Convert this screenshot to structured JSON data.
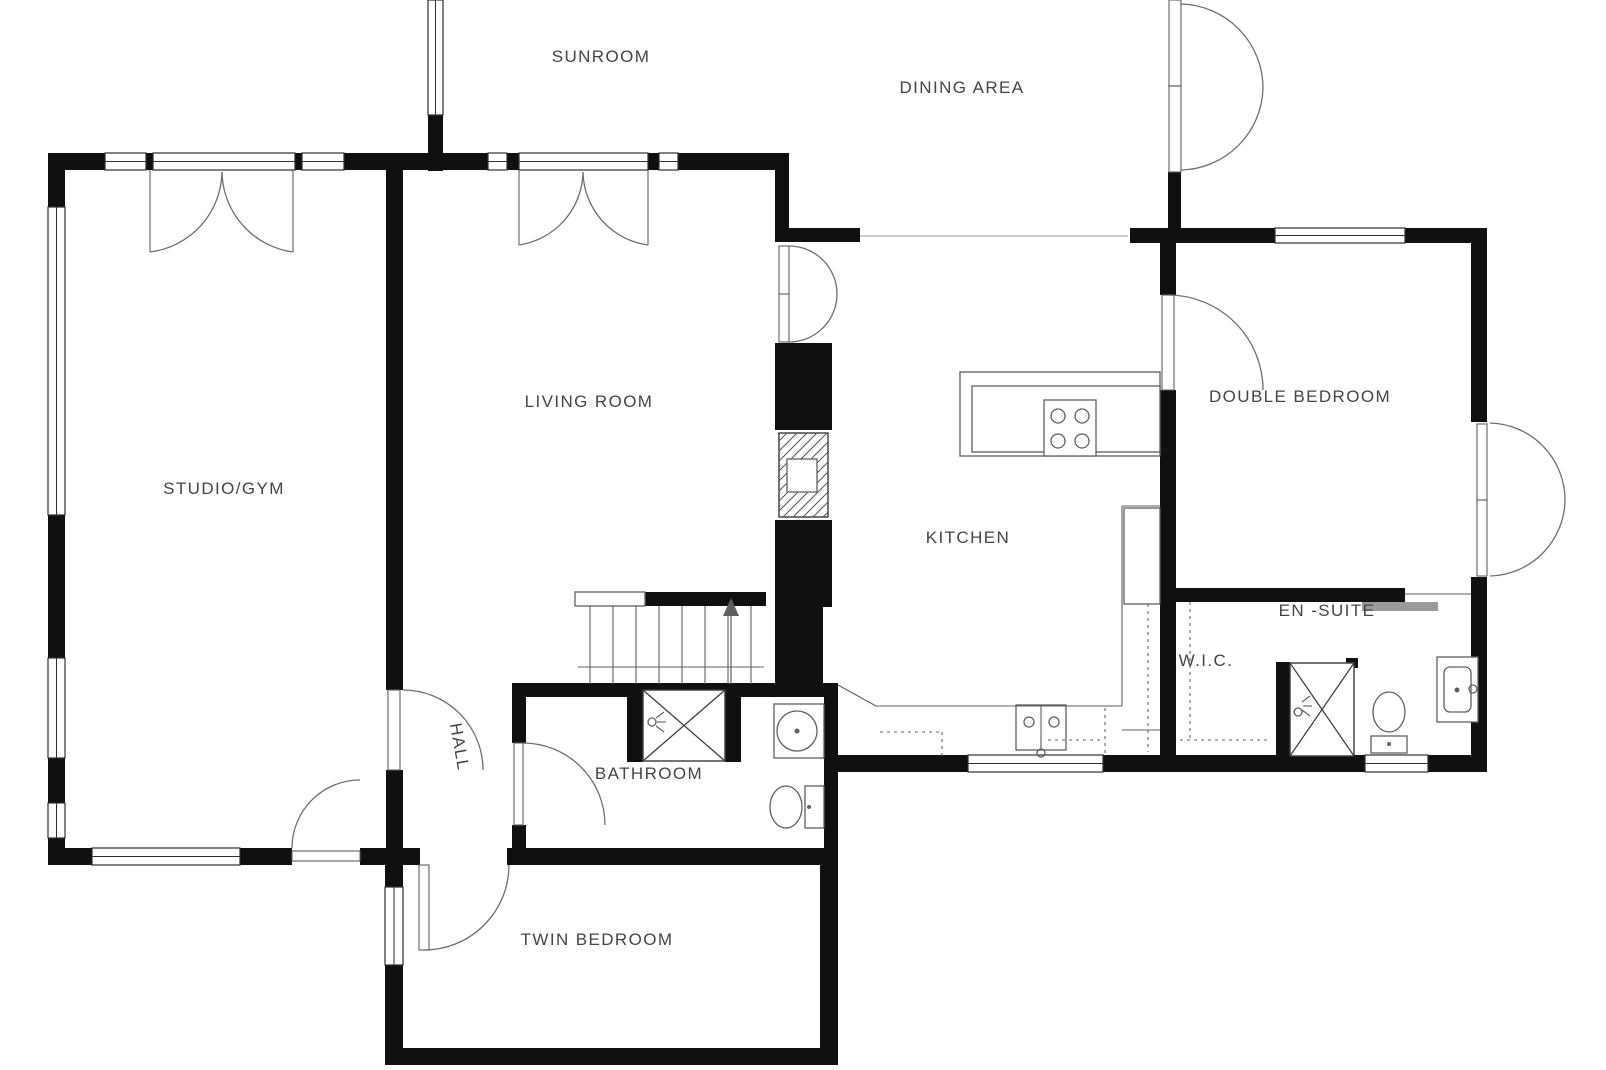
{
  "plan": {
    "title": "floor-plan",
    "width": 1606,
    "height": 1070,
    "colors": {
      "background": "#ffffff",
      "wall": "#101010",
      "window_stroke": "#2f2f2f",
      "line": "#5f5f5f",
      "arc": "#6e6e6e",
      "dash": "#666666",
      "text": "#444444",
      "radiator": "#9a9a9a"
    },
    "labels": [
      {
        "id": "sunroom",
        "text": "SUNROOM",
        "x": 601,
        "y": 57,
        "rotate": 0
      },
      {
        "id": "dining-area",
        "text": "DINING AREA",
        "x": 962,
        "y": 88,
        "rotate": 0
      },
      {
        "id": "studio-gym",
        "text": "STUDIO/GYM",
        "x": 224,
        "y": 489,
        "rotate": 0
      },
      {
        "id": "living-room",
        "text": "LIVING ROOM",
        "x": 589,
        "y": 402,
        "rotate": 0
      },
      {
        "id": "kitchen",
        "text": "KITCHEN",
        "x": 968,
        "y": 538,
        "rotate": 0
      },
      {
        "id": "double-bedroom",
        "text": "DOUBLE BEDROOM",
        "x": 1300,
        "y": 397,
        "rotate": 0
      },
      {
        "id": "en-suite",
        "text": "EN -SUITE",
        "x": 1327,
        "y": 611,
        "rotate": 0
      },
      {
        "id": "wic",
        "text": "W.I.C.",
        "x": 1206,
        "y": 661,
        "rotate": 0
      },
      {
        "id": "hall",
        "text": "HALL",
        "x": 459,
        "y": 747,
        "rotate": 80
      },
      {
        "id": "bathroom",
        "text": "BATHROOM",
        "x": 649,
        "y": 774,
        "rotate": 0
      },
      {
        "id": "twin-bedroom",
        "text": "TWIN BEDROOM",
        "x": 597,
        "y": 940,
        "rotate": 0
      }
    ],
    "geo": {
      "walls": [
        [
          48,
          153,
          57,
          17
        ],
        [
          146,
          153,
          7,
          17
        ],
        [
          295,
          153,
          7,
          17
        ],
        [
          344,
          153,
          144,
          17
        ],
        [
          507,
          153,
          12,
          17
        ],
        [
          648,
          153,
          11,
          17
        ],
        [
          678,
          153,
          111,
          17
        ],
        [
          48,
          153,
          17,
          54
        ],
        [
          48,
          264,
          17,
          5
        ],
        [
          48,
          331,
          17,
          5
        ],
        [
          48,
          515,
          17,
          143
        ],
        [
          48,
          758,
          17,
          45
        ],
        [
          48,
          838,
          17,
          27
        ],
        [
          48,
          848,
          44,
          17
        ],
        [
          163,
          848,
          6,
          17
        ],
        [
          240,
          848,
          52,
          17
        ],
        [
          360,
          848,
          43,
          17
        ],
        [
          386,
          153,
          17,
          537
        ],
        [
          386,
          770,
          17,
          95
        ],
        [
          403,
          848,
          17,
          17
        ],
        [
          507,
          848,
          5,
          17
        ],
        [
          775,
          153,
          14,
          89
        ],
        [
          775,
          343,
          57,
          87
        ],
        [
          775,
          520,
          57,
          87
        ],
        [
          775,
          607,
          48,
          78
        ],
        [
          775,
          228,
          85,
          14
        ],
        [
          512,
          683,
          326,
          14
        ],
        [
          512,
          683,
          14,
          60
        ],
        [
          512,
          825,
          14,
          40
        ],
        [
          824,
          683,
          14,
          182
        ],
        [
          627,
          683,
          16,
          79
        ],
        [
          725,
          683,
          16,
          79
        ],
        [
          512,
          848,
          326,
          17
        ],
        [
          385,
          865,
          18,
          22
        ],
        [
          385,
          965,
          18,
          83
        ],
        [
          385,
          1048,
          453,
          17
        ],
        [
          820,
          865,
          18,
          183
        ],
        [
          838,
          755,
          130,
          17
        ],
        [
          1035,
          755,
          6,
          17
        ],
        [
          1103,
          755,
          262,
          17
        ],
        [
          1428,
          755,
          59,
          17
        ],
        [
          428,
          115,
          15,
          56
        ],
        [
          428,
          50,
          15,
          5
        ],
        [
          1168,
          172,
          13,
          71
        ],
        [
          1130,
          228,
          145,
          15
        ],
        [
          1338,
          228,
          6,
          15
        ],
        [
          1405,
          228,
          82,
          15
        ],
        [
          1160,
          243,
          16,
          52
        ],
        [
          1160,
          390,
          16,
          382
        ],
        [
          1471,
          243,
          16,
          179
        ],
        [
          1471,
          577,
          16,
          178
        ],
        [
          1160,
          588,
          245,
          14
        ],
        [
          1276,
          662,
          14,
          95
        ],
        [
          1346,
          658,
          12,
          10
        ],
        [
          645,
          592,
          121,
          14
        ]
      ],
      "windows": [
        [
          105,
          153,
          41,
          17
        ],
        [
          153,
          153,
          142,
          17
        ],
        [
          302,
          153,
          42,
          17
        ],
        [
          488,
          153,
          19,
          17
        ],
        [
          519,
          153,
          129,
          17
        ],
        [
          659,
          153,
          19,
          17
        ],
        [
          48,
          207,
          17,
          308
        ],
        [
          48,
          658,
          17,
          100
        ],
        [
          48,
          803,
          17,
          35
        ],
        [
          92,
          848,
          148,
          17
        ],
        [
          428,
          0,
          15,
          115
        ],
        [
          385,
          887,
          18,
          78
        ],
        [
          968,
          755,
          135,
          17
        ],
        [
          1365,
          755,
          63,
          17
        ],
        [
          1275,
          228,
          130,
          15
        ]
      ],
      "leaves": [
        [
          292,
          851,
          68,
          10,
          "studio-exterior-door-leaf"
        ],
        [
          388,
          690,
          12,
          80,
          "hall-door-leaf"
        ],
        [
          514,
          743,
          9,
          82,
          "bathroom-door-leaf"
        ],
        [
          419,
          865,
          10,
          85,
          "twin-bedroom-door-leaf"
        ],
        [
          1162,
          295,
          12,
          95,
          "double-bedroom-door-leaf"
        ],
        [
          779,
          246,
          10,
          48,
          "living-room-door-leaf"
        ],
        [
          779,
          294,
          10,
          48,
          "living-room-door-leaf"
        ],
        [
          1169,
          0,
          12,
          86,
          "dining-french-door-leaf"
        ],
        [
          1169,
          86,
          12,
          86,
          "dining-french-door-leaf"
        ],
        [
          1477,
          424,
          10,
          76,
          "bedroom-french-door-leaf"
        ],
        [
          1477,
          500,
          10,
          76,
          "bedroom-french-door-leaf"
        ]
      ],
      "arcs": [
        "M150,252 A82 82 0 0 0 222,172",
        "M293,252 A82 82 0 0 1 222,172",
        "M519,245 A75 75 0 0 0 583,172",
        "M648,245 A75 75 0 0 1 583,172",
        "M789,246 A48 48 0 0 1 837,294",
        "M789,342 A48 48 0 0 0 837,294",
        "M1181,4 A84 84 0 0 1 1263,88",
        "M1181,170 A84 84 0 0 0 1263,88",
        "M1490,423 A77 77 0 0 1 1565,500",
        "M1490,576 A77 77 0 0 0 1565,500",
        "M292,848 A68 68 0 0 1 360,780",
        "M403,690 A80 80 0 0 1 483,770",
        "M523,743 A82 82 0 0 1 605,825",
        "M424,950 A85 85 0 0 0 509,865",
        "M1168,295 A95 95 0 0 1 1263,390"
      ],
      "boxes": [
        [
          960,
          372,
          200,
          84,
          0,
          "kitchen-island"
        ],
        [
          972,
          386,
          188,
          66,
          0,
          "kitchen-island-inner"
        ],
        [
          1044,
          400,
          52,
          56,
          0,
          "stove"
        ],
        [
          1016,
          705,
          50,
          45,
          0,
          "kitchen-sink"
        ],
        [
          1124,
          508,
          36,
          96,
          0,
          "kitchen-cabinet"
        ],
        [
          774,
          704,
          50,
          54,
          0,
          "bathroom-basin"
        ],
        [
          1437,
          657,
          41,
          65,
          0,
          "ensuite-basin"
        ],
        [
          1444,
          667,
          27,
          45,
          6,
          "ensuite-basin-inner"
        ],
        [
          575,
          592,
          70,
          14,
          0,
          "stair-rail"
        ],
        [
          1371,
          736,
          36,
          17,
          0,
          "ensuite-toilet-tank"
        ],
        [
          805,
          786,
          19,
          42,
          0,
          "bathroom-toilet-tank"
        ],
        [
          787,
          459,
          30,
          33,
          0,
          "chimney-flue"
        ]
      ],
      "xboxes": [
        [
          643,
          690,
          82,
          71,
          "bathroom-shower"
        ],
        [
          1290,
          663,
          64,
          93,
          "ensuite-shower"
        ]
      ],
      "hatch": [
        779,
        433,
        49,
        84
      ],
      "lines": [
        [
          150,
          170,
          150,
          252
        ],
        [
          293,
          170,
          293,
          252
        ],
        [
          519,
          170,
          519,
          245
        ],
        [
          648,
          170,
          648,
          245
        ],
        [
          590,
          606,
          590,
          684
        ],
        [
          613,
          606,
          613,
          684
        ],
        [
          636,
          606,
          636,
          684
        ],
        [
          659,
          606,
          659,
          684
        ],
        [
          682,
          606,
          682,
          684
        ],
        [
          705,
          606,
          705,
          684
        ],
        [
          728,
          606,
          728,
          684
        ],
        [
          751,
          606,
          751,
          684
        ],
        [
          578,
          667,
          764,
          667
        ],
        [
          838,
          685,
          876,
          706
        ],
        [
          876,
          706,
          1122,
          706
        ],
        [
          1122,
          706,
          1122,
          506
        ],
        [
          1122,
          506,
          1160,
          506
        ],
        [
          1122,
          730,
          1160,
          730
        ],
        [
          1041,
          705,
          1041,
          750
        ],
        [
          1041,
          742,
          1041,
          749
        ],
        [
          1168,
          86,
          1181,
          86
        ],
        [
          1405,
          594,
          1471,
          594
        ],
        [
          656,
          718,
          664,
          712
        ],
        [
          657,
          722,
          666,
          722
        ],
        [
          656,
          726,
          664,
          732
        ],
        [
          1302,
          702,
          1310,
          696
        ],
        [
          1303,
          706,
          1312,
          706
        ],
        [
          1302,
          710,
          1310,
          716
        ]
      ],
      "threshold": [
        [
          860,
          236,
          1128,
          236
        ]
      ],
      "dashed": [
        [
          880,
          732,
          942,
          732
        ],
        [
          942,
          732,
          942,
          757
        ],
        [
          1105,
          708,
          1105,
          757
        ],
        [
          1148,
          604,
          1148,
          752
        ],
        [
          1180,
          740,
          1268,
          740
        ],
        [
          1190,
          602,
          1190,
          740
        ],
        [
          1048,
          740,
          1102,
          740
        ]
      ],
      "circles": [
        [
          1058,
          416,
          7
        ],
        [
          1082,
          416,
          7
        ],
        [
          1058,
          441,
          7
        ],
        [
          1082,
          441,
          7
        ],
        [
          797,
          731,
          20
        ],
        [
          1029,
          722,
          5
        ],
        [
          1054,
          722,
          5
        ],
        [
          1041,
          753,
          4
        ],
        [
          652,
          722,
          4
        ],
        [
          1298,
          712,
          4
        ],
        [
          1473,
          689,
          4
        ]
      ],
      "dots": [
        [
          797,
          731,
          2.5
        ],
        [
          1457,
          690,
          2.5
        ],
        [
          809,
          807,
          2
        ],
        [
          1389,
          744,
          2
        ]
      ],
      "ellipses": [
        [
          786,
          807,
          16,
          21,
          "bathroom-toilet-bowl"
        ],
        [
          1389,
          712,
          16,
          20,
          "ensuite-toilet-bowl"
        ]
      ],
      "fills": [
        [
          1362,
          602,
          76,
          9,
          "radiator",
          "sliding-door"
        ]
      ],
      "arrow": {
        "line": [
          731,
          610,
          731,
          684
        ],
        "head": [
          [
            731,
            598
          ],
          [
            723,
            616
          ],
          [
            739,
            616
          ]
        ]
      }
    }
  }
}
